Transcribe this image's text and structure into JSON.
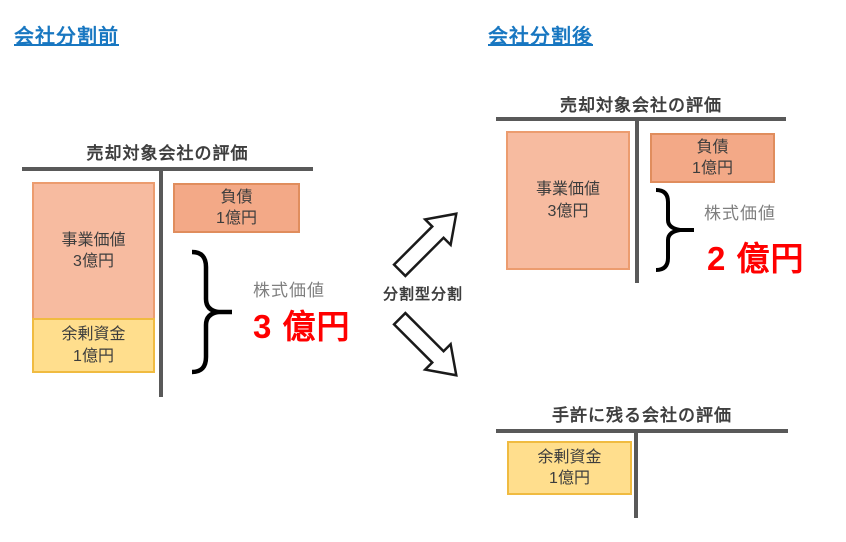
{
  "headings": {
    "before": "会社分割前",
    "after": "会社分割後"
  },
  "before_diagram": {
    "title": "売却対象会社の評価",
    "business_value": {
      "label": "事業価値",
      "amount": "3億円"
    },
    "surplus_funds": {
      "label": "余剰資金",
      "amount": "1億円"
    },
    "debt": {
      "label": "負債",
      "amount": "1億円"
    },
    "equity_label": "株式価値",
    "equity_amount": "3 億円"
  },
  "split_arrow": {
    "label": "分割型分割"
  },
  "after_sold_diagram": {
    "title": "売却対象会社の評価",
    "business_value": {
      "label": "事業価値",
      "amount": "3億円"
    },
    "debt": {
      "label": "負債",
      "amount": "1億円"
    },
    "equity_label": "株式価値",
    "equity_amount": "2 億円"
  },
  "after_remaining_diagram": {
    "title": "手許に残る会社の評価",
    "surplus_funds": {
      "label": "余剰資金",
      "amount": "1億円"
    }
  },
  "icons": {
    "brace_left": "curly-brace",
    "brace_right": "curly-brace",
    "arrow_up": "arrow-up-right",
    "arrow_down": "arrow-down-right"
  },
  "colors": {
    "heading_blue": "#1877C1",
    "line_gray": "#595959",
    "title_text": "#3F3F3F",
    "box_text": "#3D3D3D",
    "equity_label_gray": "#7F7F7F",
    "equity_value_red": "#FF0000",
    "business_fill": "#F7BBA0",
    "business_border": "#EC9C6F",
    "debt_fill": "#F3A987",
    "debt_border": "#E08D5D",
    "surplus_fill": "#FFDE8D",
    "surplus_border": "#F0BB41"
  }
}
